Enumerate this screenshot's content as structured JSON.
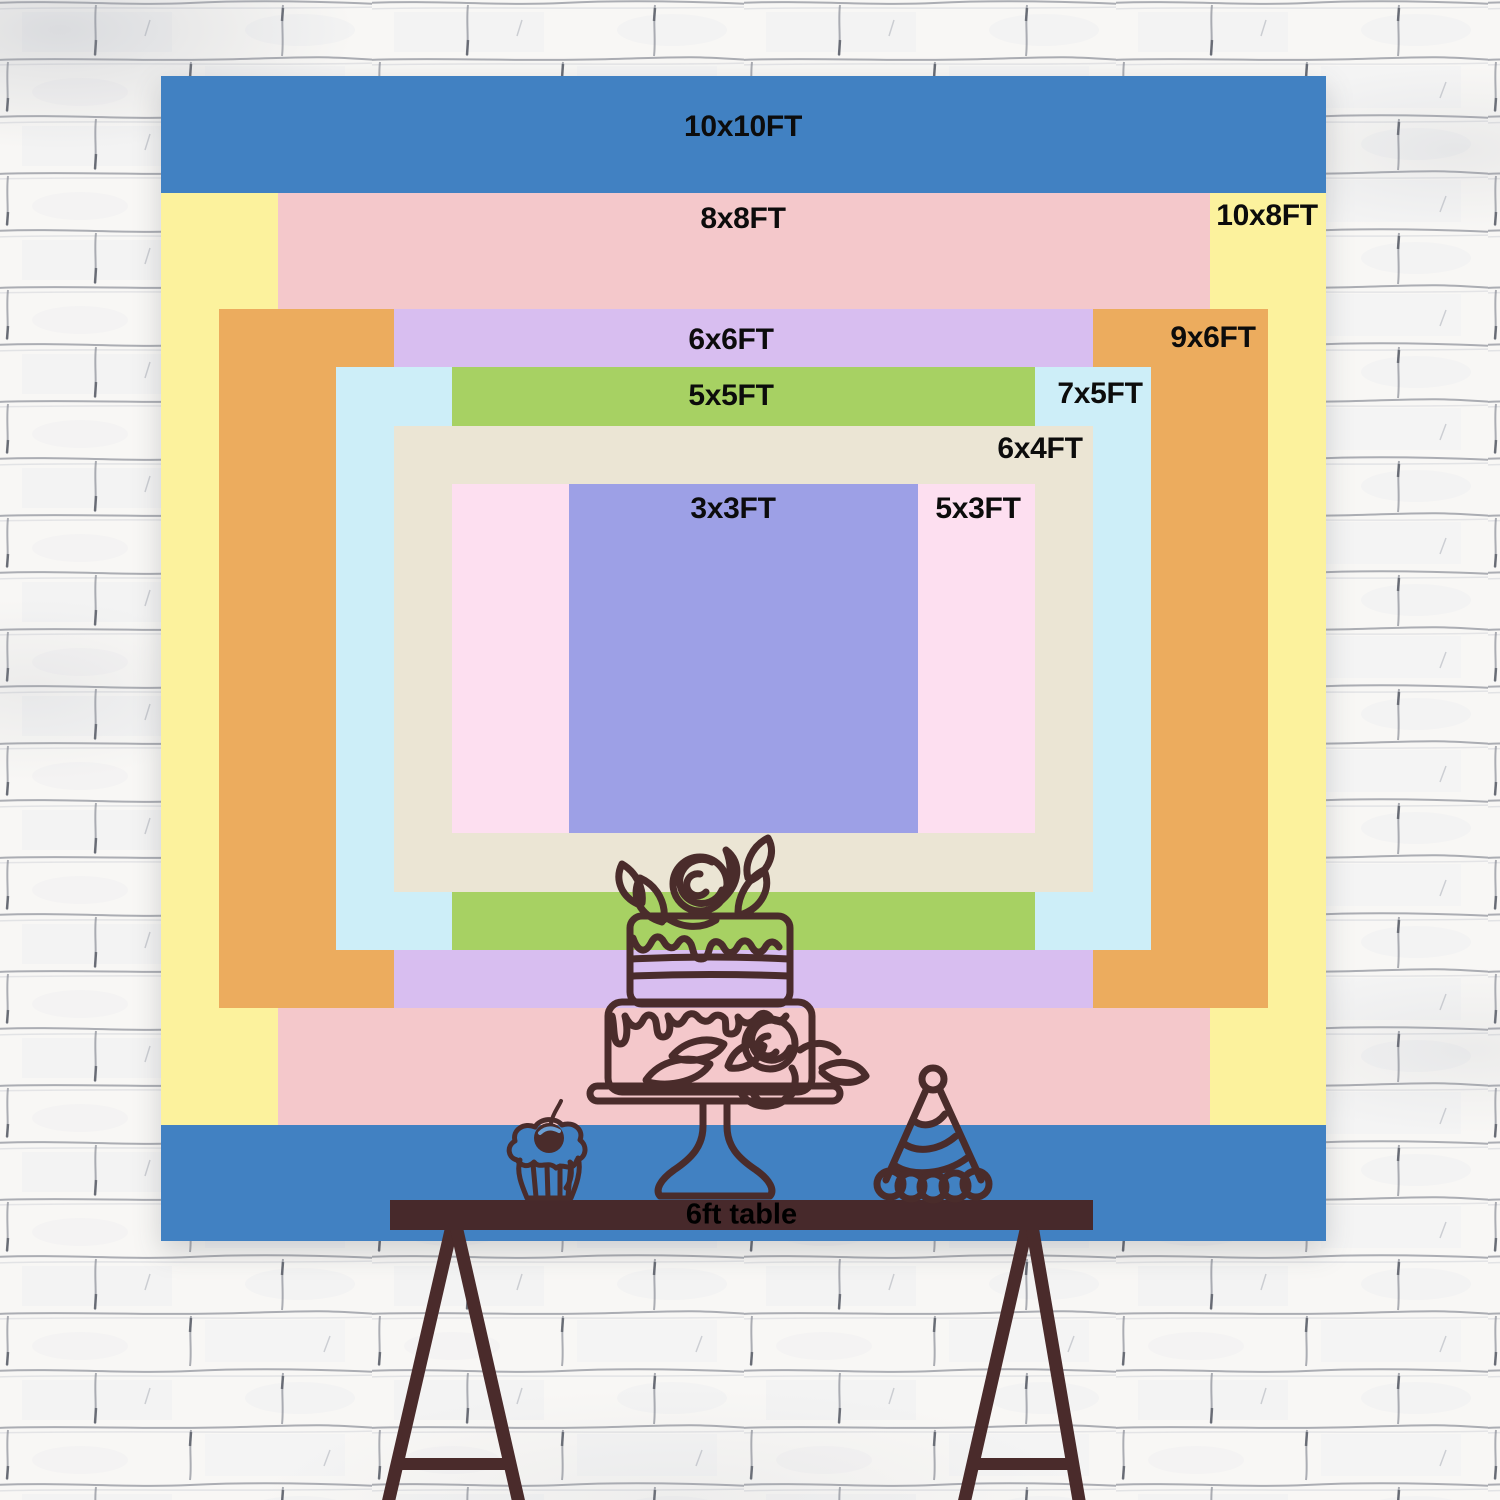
{
  "backdrop": {
    "origin": {
      "x": 161,
      "y": 76
    },
    "size_px": 1165,
    "px_per_ft": 116.5,
    "layers": [
      {
        "label": "10x10FT",
        "w_ft": 10,
        "h_ft": 10,
        "color": "#4181c2",
        "label_x": 582,
        "label_y": 51
      },
      {
        "label": "10x8FT",
        "w_ft": 10,
        "h_ft": 8,
        "color": "#fcf29d",
        "label_x": 1106,
        "label_y": 140
      },
      {
        "label": "8x8FT",
        "w_ft": 8,
        "h_ft": 8,
        "color": "#f4c8cb",
        "label_x": 582,
        "label_y": 143
      },
      {
        "label": "9x6FT",
        "w_ft": 9,
        "h_ft": 6,
        "color": "#ecac5e",
        "label_x": 1052,
        "label_y": 262
      },
      {
        "label": "6x6FT",
        "w_ft": 6,
        "h_ft": 6,
        "color": "#d8bef0",
        "label_x": 570,
        "label_y": 264
      },
      {
        "label": "7x5FT",
        "w_ft": 7,
        "h_ft": 5,
        "color": "#cdeef8",
        "label_x": 939,
        "label_y": 318
      },
      {
        "label": "5x5FT",
        "w_ft": 5,
        "h_ft": 5,
        "color": "#a7d163",
        "label_x": 570,
        "label_y": 320
      },
      {
        "label": "6x4FT",
        "w_ft": 6,
        "h_ft": 4,
        "color": "#ebe5d4",
        "label_x": 879,
        "label_y": 373
      },
      {
        "label": "5x3FT",
        "w_ft": 5,
        "h_ft": 3,
        "color": "#fddff0",
        "label_x": 817,
        "label_y": 433
      },
      {
        "label": "3x3FT",
        "w_ft": 3,
        "h_ft": 3,
        "color": "#9da0e6",
        "label_x": 572,
        "label_y": 433
      }
    ]
  },
  "table": {
    "label": "6ft table",
    "color": "#47292b",
    "x": 390,
    "y": 1200,
    "width": 703,
    "height": 30
  },
  "illustration": {
    "line_color": "#4a2c2b",
    "items": [
      "tiered-cake",
      "cupcake-with-cherry",
      "party-hat"
    ]
  },
  "wall": {
    "bg": "#f8f7f5",
    "mortar_line_color": "#8a8e98",
    "dark_accent_color": "#565a64"
  }
}
